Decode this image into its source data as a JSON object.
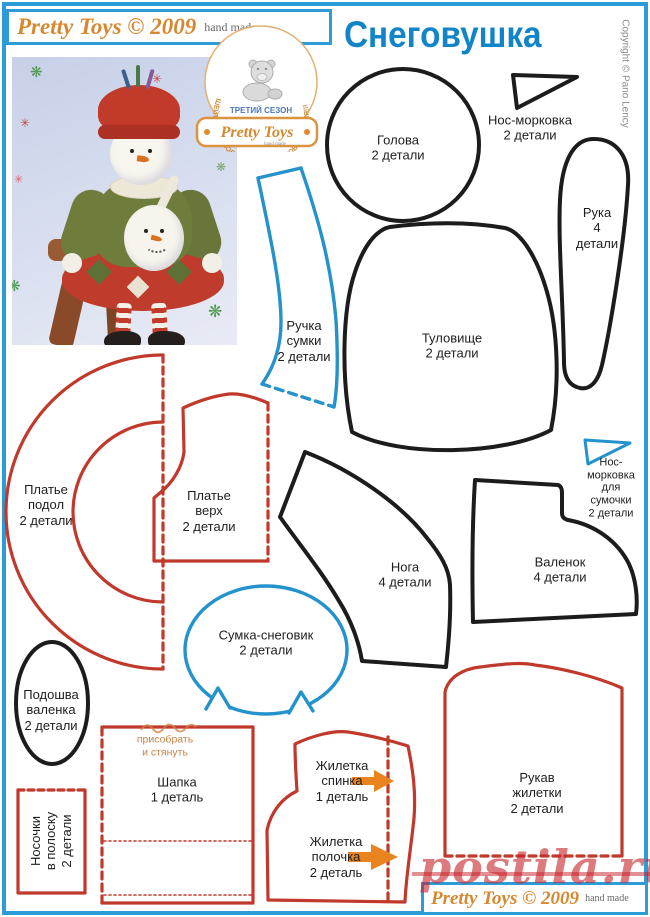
{
  "header": {
    "brand": "Pretty Toys © 2009",
    "handmade": "hand made"
  },
  "title": "Снеговушка",
  "copyright_vertical": "Copyright © Pano Lency",
  "logo": {
    "arc_text": "ШЕЙТЕ С УДОВОЛЬСТВИЕМ ДЛЯ УДОВОЛЬСТВИЯ!!!",
    "season": "ТРЕТИЙ СЕЗОН",
    "brand": "Pretty Toys",
    "sub": "hand made"
  },
  "pieces": {
    "head": "Голова\n2 детали",
    "nose": "Нос-морковка\n2 детали",
    "arm": "Рука\n4 детали",
    "bag_handle": "Ручка\nсумки\n2 детали",
    "body": "Туловище\n2 детали",
    "dress_hem": "Платье\nподол\n2 детали",
    "dress_top": "Платье\nверх\n2 детали",
    "leg": "Нога\n4 детали",
    "boot": "Валенок\n4 детали",
    "bag_nose": "Нос-\nморковка\nдля сумочки\n2 детали",
    "bag": "Сумка-снеговик\n2 детали",
    "sole": "Подошва\nваленка\n2 детали",
    "socks": "Носочки\nв полоску\n2 детали",
    "hat": "Шапка\n1 деталь",
    "vest_back": "Жилетка\nспинка\n1 деталь",
    "vest_front": "Жилетка\nполочка\n2 деталь",
    "sleeve": "Рукав\nжилетки\n2 детали"
  },
  "notes": {
    "gather": "присобрать\nи стянуть"
  },
  "footer": {
    "brand": "Pretty Toys © 2009",
    "handmade": "hand made"
  },
  "watermark": "postila.ru",
  "colors": {
    "page_border_blue": "#2b9cd8",
    "title_blue": "#1285c8",
    "brand_orange": "#d7882f",
    "outline_black": "#1c1c1c",
    "outline_red": "#c0392b",
    "outline_blue": "#2492cc",
    "arrow_orange": "#e8831d",
    "watermark_red": "#c62228"
  }
}
